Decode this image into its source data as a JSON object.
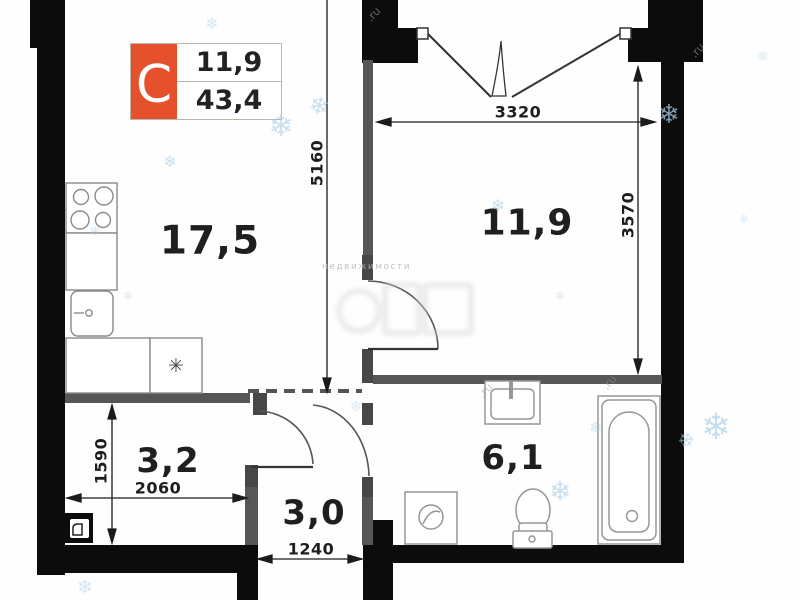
{
  "plan": {
    "badge": {
      "letter": "С",
      "top_value": "11,9",
      "bottom_value": "43,4",
      "accent_color": "#e4512c"
    },
    "rooms": [
      {
        "id": "living-kitchen",
        "area": "17,5"
      },
      {
        "id": "bedroom",
        "area": "11,9"
      },
      {
        "id": "room-left",
        "area": "3,2"
      },
      {
        "id": "hallway",
        "area": "3,0"
      },
      {
        "id": "bathroom",
        "area": "6,1"
      }
    ],
    "dimensions": {
      "v5160": "5160",
      "h3320": "3320",
      "v3570": "3570",
      "v1590": "1590",
      "h2060": "2060",
      "h1240": "1240"
    },
    "fixtures": [
      "stove",
      "kitchen-sink",
      "kitchen-counter",
      "bathtub",
      "toilet",
      "wash-basin",
      "washing-machine",
      "electrical-panel"
    ],
    "colors": {
      "wall": "#0c0c0c",
      "partition": "#565656",
      "accent_orange": "#e4512c",
      "snowflake": "#a7cde6"
    },
    "decor": {
      "snowflake_glyph": "❄",
      "star_glyph": "✳",
      "watermark_small": "недвижимости",
      "watermark_ru": ".ru"
    }
  }
}
